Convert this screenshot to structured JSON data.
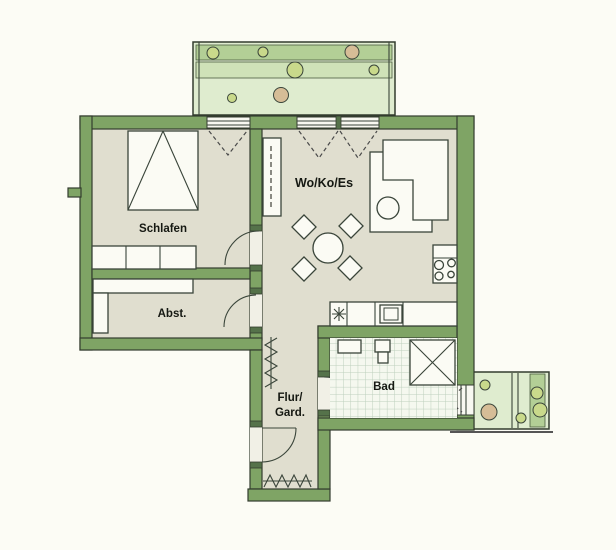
{
  "floor_plan": {
    "rooms": {
      "bedroom": {
        "label": "Schlafen"
      },
      "living_kitchen_dining": {
        "label": "Wo/Ko/Es"
      },
      "storage": {
        "label": "Abst."
      },
      "hallway": {
        "label_line1": "Flur/",
        "label_line2": "Gard."
      },
      "bathroom": {
        "label": "Bad"
      }
    },
    "colors": {
      "wall_green": "#7fa465",
      "room_floor_beige": "#e0decf",
      "balcony_green": "#dfeccf",
      "balcony_band_green": "#b3cf96",
      "planter_green": "#c9d98b",
      "planter_tan": "#d6bd97",
      "tile_line": "#bdd0bd",
      "outline": "#333c2e"
    },
    "symbols": {
      "bed": "rectangle-with-triangle",
      "wardrobe": "three-cell-cabinet",
      "dining_set": "round-table-with-4-diamond-chairs",
      "sofa": "l-shaped-couch-with-round-table",
      "stove": "four-burner-circles",
      "sink": "double-square",
      "drain_star": "eight-point-asterisk",
      "shower": "square-with-x",
      "coat_rack": "zigzag-line",
      "door": "quarter-circle-arc",
      "balcony_door": "dashed-v"
    }
  }
}
